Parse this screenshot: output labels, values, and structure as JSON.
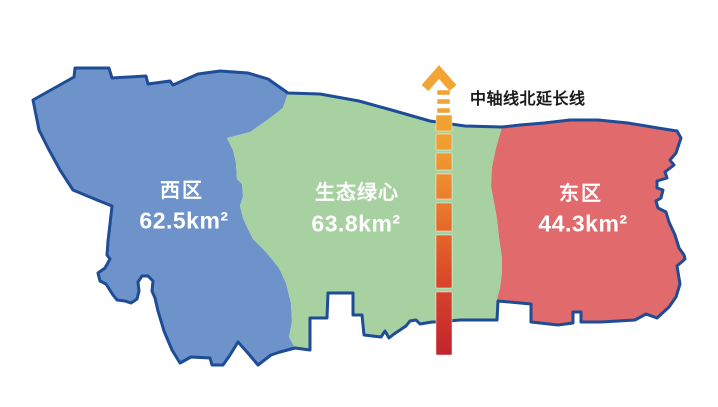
{
  "map": {
    "outline_color": "#1E4C96",
    "regions": [
      {
        "name": "西区",
        "area_label": "62.5km²",
        "area_km2": 62.5,
        "fill": "#6E92CA",
        "label_color": "#ffffff"
      },
      {
        "name": "生态绿心",
        "area_label": "63.8km²",
        "area_km2": 63.8,
        "fill": "#A7D1A0",
        "label_color": "#ffffff"
      },
      {
        "name": "东区",
        "area_label": "44.3km²",
        "area_km2": 44.3,
        "fill": "#E16A6C",
        "label_color": "#ffffff"
      }
    ]
  },
  "axis": {
    "label": "中轴线北延长线",
    "label_color": "#1a1a1a",
    "gradient_top": "#F3A634",
    "gradient_mid": "#EC862D",
    "gradient_bottom": "#C1232E"
  }
}
